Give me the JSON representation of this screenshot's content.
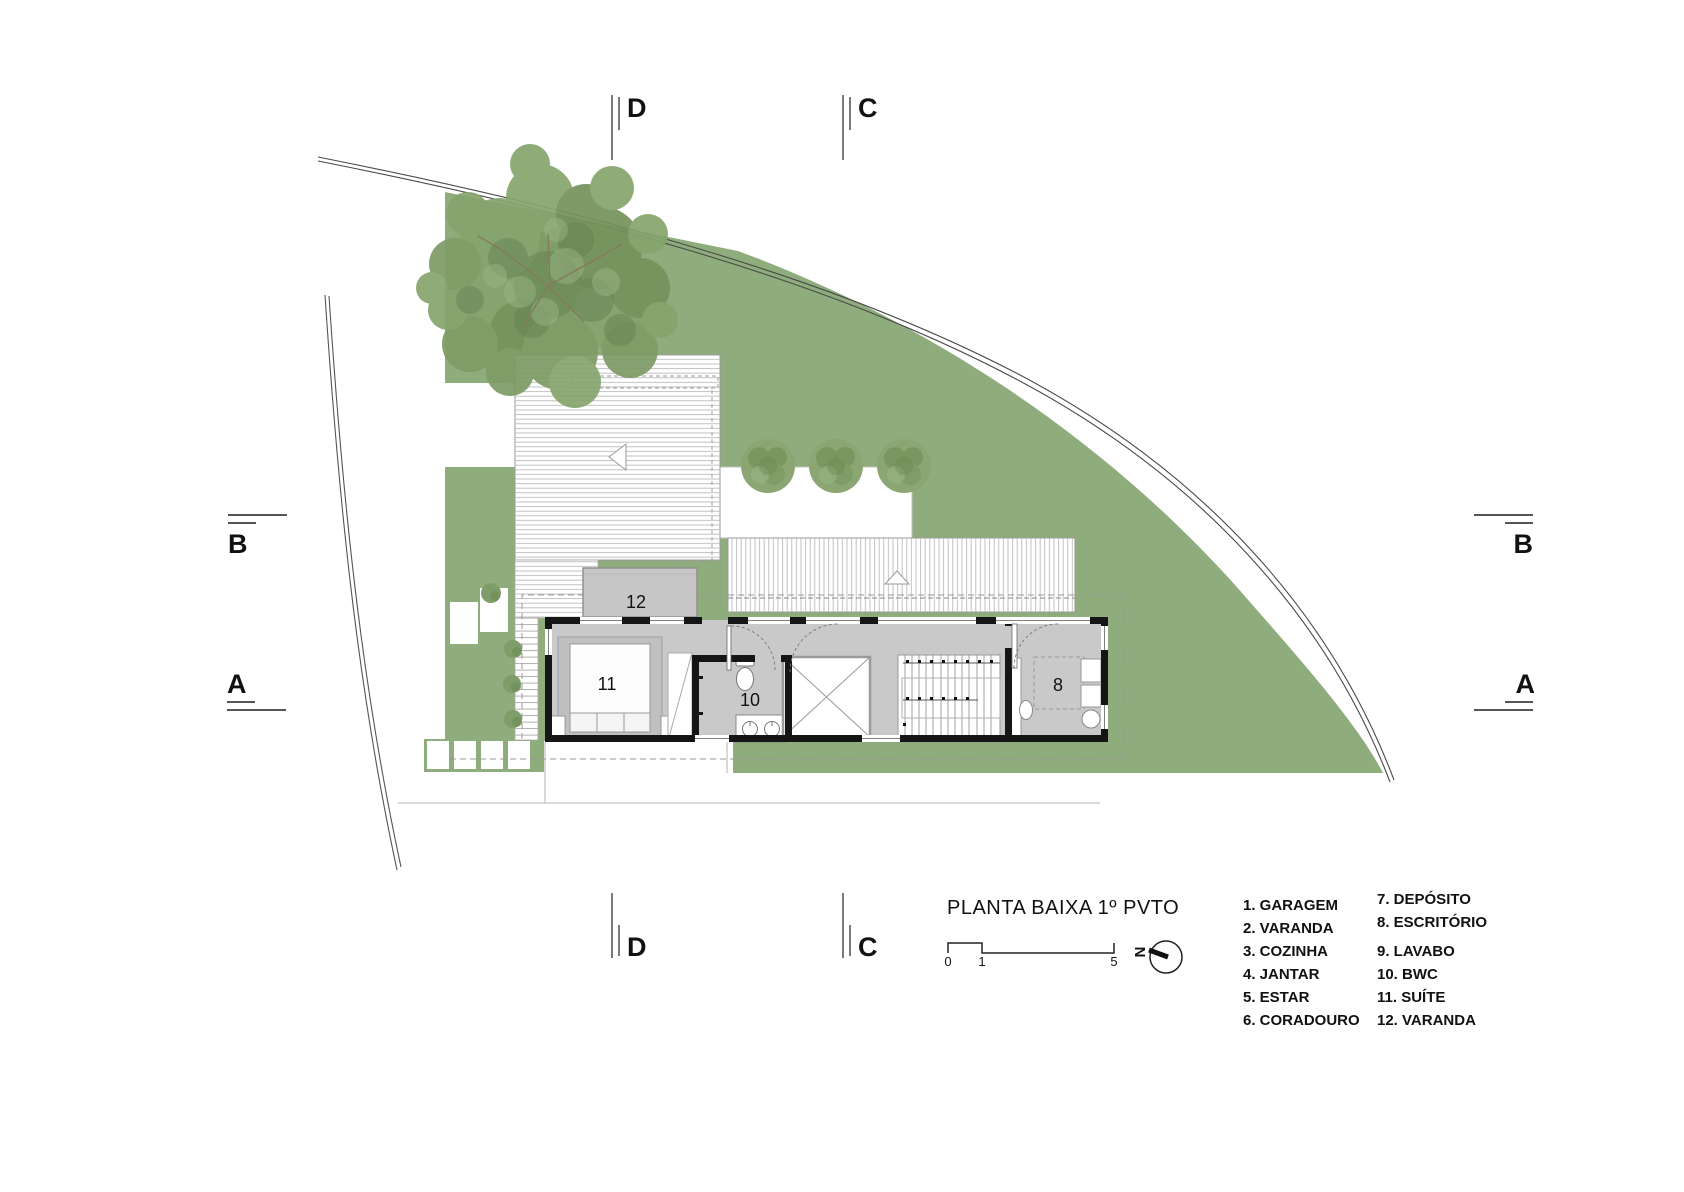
{
  "title": "PLANTA BAIXA 1º PVTO",
  "rooms": {
    "r12": "12",
    "r11": "11",
    "r10": "10",
    "r8": "8"
  },
  "sections": {
    "d": "D",
    "c": "C",
    "b": "B",
    "a": "A"
  },
  "scalebar": {
    "t0": "0",
    "t1": "1",
    "t2": "5"
  },
  "north": {
    "label": "N"
  },
  "legend": {
    "col1": [
      "1. GARAGEM",
      "2. VARANDA",
      "3. COZINHA",
      "4. JANTAR",
      "5. ESTAR",
      "6. CORADOURO"
    ],
    "col2": [
      "7. DEPÓSITO",
      "8. ESCRITÓRIO",
      "9. LAVABO",
      "10. BWC",
      "11. SUÍTE",
      "12. VARANDA"
    ]
  },
  "colors": {
    "grass": "#8fac7c",
    "tree_foliage": "#7e9c66",
    "floor_gray": "#c9c9c9",
    "varanda_gray": "#c6c6c6",
    "wall_black": "#151515",
    "hatch_gray": "#b9b9b9"
  }
}
